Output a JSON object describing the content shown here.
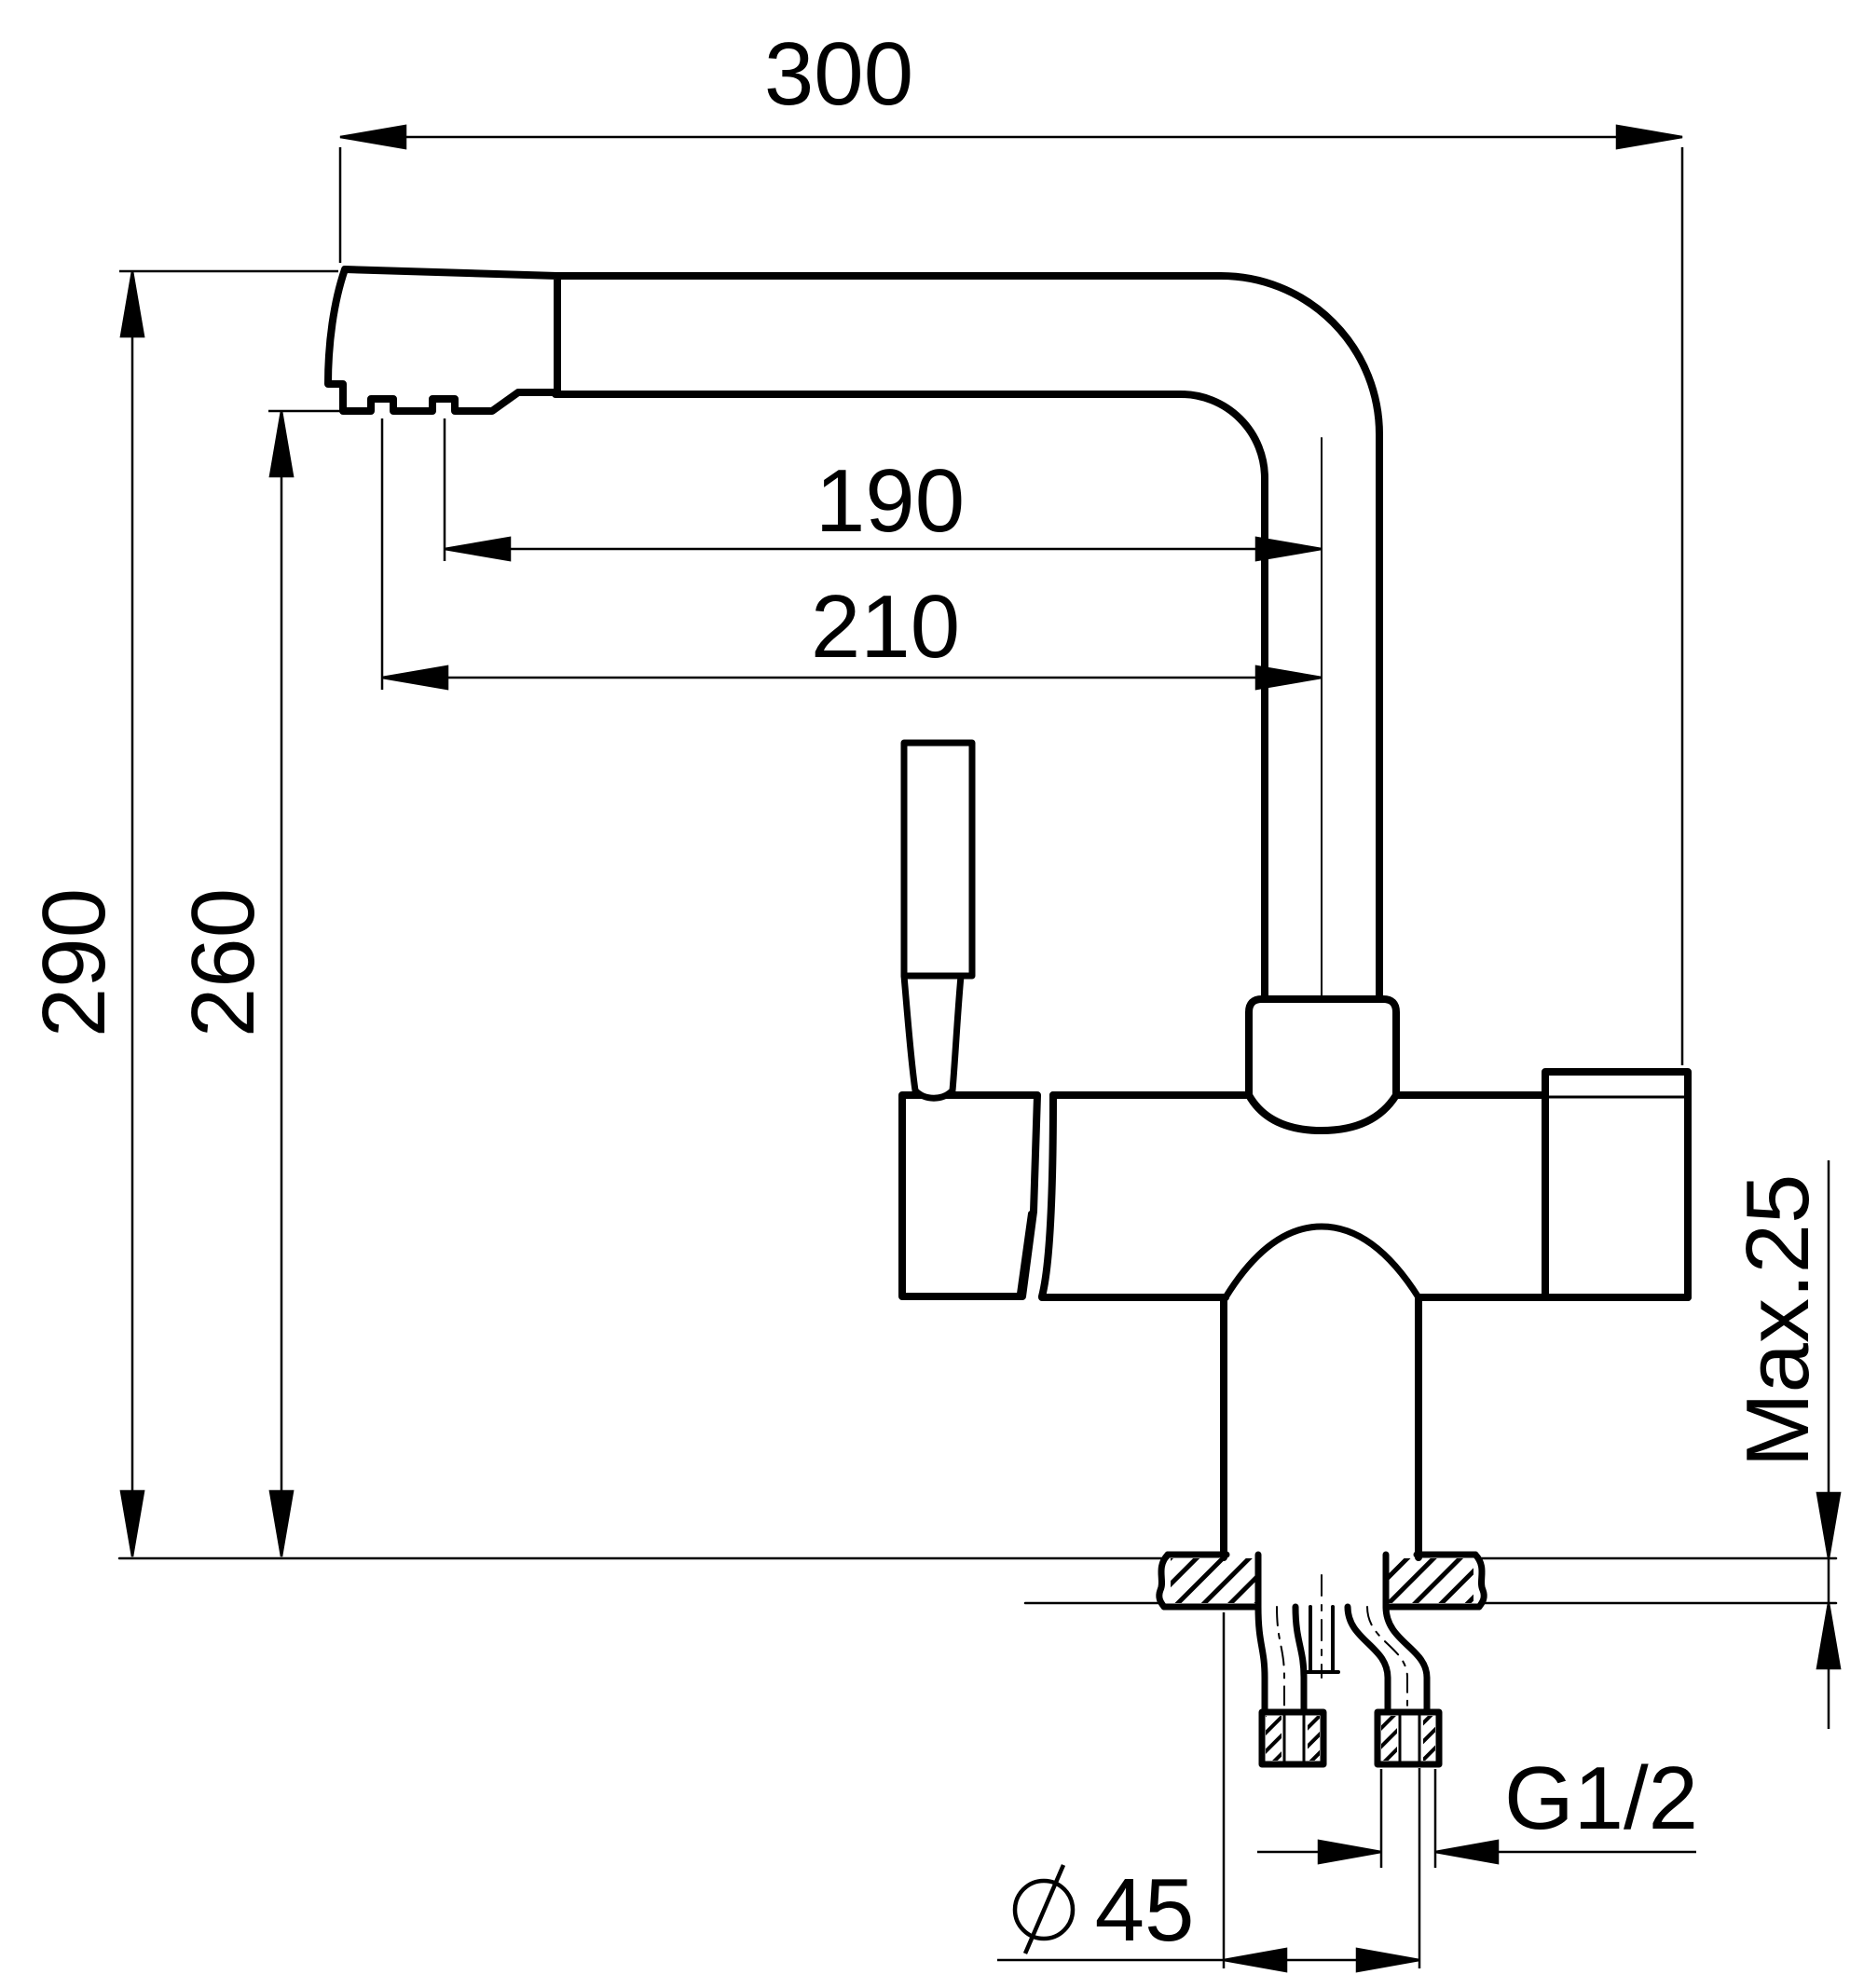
{
  "drawing": {
    "background": "#ffffff",
    "line_color": "#000000",
    "labels": {
      "width_overall": "300",
      "reach_outlet_to_axis": "190",
      "reach_tip_to_axis": "210",
      "height_overall": "290",
      "height_to_outlet": "260",
      "max_deck_thickness": "Max.25",
      "connection_thread": "G1/2",
      "base_diameter_value": "45"
    },
    "icons": {
      "diameter_symbol": "circle-with-slash"
    }
  }
}
